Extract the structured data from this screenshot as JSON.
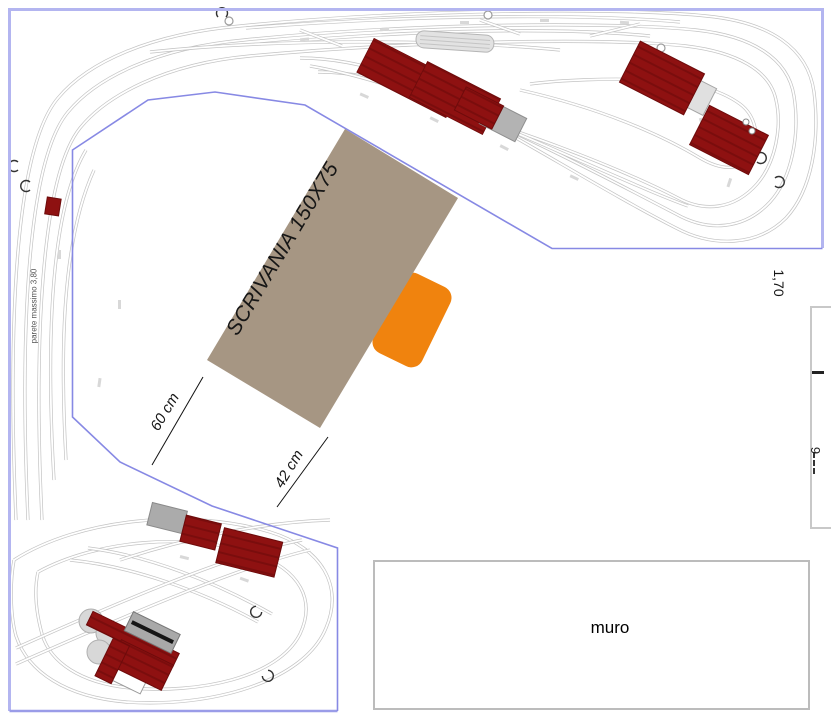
{
  "plan": {
    "desk_label": "SCRIVANIA 150X75",
    "dim_left": "60 cm",
    "dim_right": "42 cm",
    "dim_vertical": "1,70",
    "wall_label": "muro",
    "left_wall_note": "parete massimo 3,80",
    "right_edge_fragment": "9"
  },
  "colors": {
    "room_border": "#b3b5f0",
    "inner_boundary": "#8789e4",
    "track": "#c3c3c3",
    "building_red": "#8e1111",
    "building_gray": "#b3b3b3",
    "desk": "#a69683",
    "chair_orange": "#f0830e",
    "wall_rect_border": "#bcbcbc"
  }
}
